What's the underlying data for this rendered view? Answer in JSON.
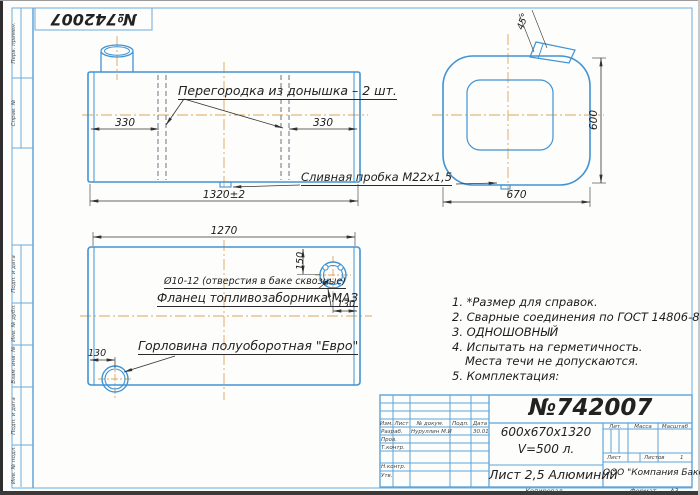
{
  "colors": {
    "line_blue": "#4093d4",
    "frame_blue": "#6cabdc",
    "centerline_orange": "#dca55e",
    "text_black": "#222222"
  },
  "stamp": {
    "number": "№742007"
  },
  "margin": {
    "perv_primen": "Перв. примен.",
    "sprav_no": "Справ. №",
    "podp_data_1": "Подп. и дата",
    "inv_dubl": "Инв. № дубл.",
    "vzam_inv": "Взам. инв. №",
    "podp_data_2": "Подп. и дата",
    "inv_podl": "Инв. № подл."
  },
  "front_view": {
    "partition_label": "Перегородка из донышка – 2 шт.",
    "dim_330_left": "330",
    "dim_330_right": "330",
    "dim_length": "1320±2",
    "drain_label": "Сливная пробка М22х1,5"
  },
  "side_view": {
    "dim_height": "600",
    "dim_width": "670",
    "dim_angle": "45°"
  },
  "top_view": {
    "dim_length": "1270",
    "holes_label": "Ø10-12 (отверстия в баке сквозные)",
    "flange_label": "Фланец топливозаборника МАЗ",
    "neck_label": "Горловина полуоборотная \"Евро\"",
    "dim_flange_top": "150",
    "dim_flange_right": "130",
    "dim_neck_left": "130"
  },
  "notes": {
    "line1": "1. *Размер для справок.",
    "line2": "2. Сварные соединения по ГОСТ 14806-80.",
    "line3": "3. ОДНОШОВНЫЙ",
    "line4": "4. Испытать на герметичность.",
    "line5": "Места течи не допускаются.",
    "line6": "5. Комплектация:"
  },
  "title_block": {
    "doc_number": "№742007",
    "size_line": "600х670х1320",
    "volume_line": "V=500 л.",
    "material": "Лист 2,5 Алюминий",
    "company": "ООО \"Компания Бакор\"",
    "col_izm": "Изм.",
    "col_list": "Лист",
    "col_docum": "№ докум.",
    "col_podp": "Подп.",
    "col_data": "Дата",
    "razrab": "Разраб.",
    "razrab_name": "Нуруллин М.И",
    "razrab_date": "30.01",
    "prov": "Пров.",
    "tkontr": "Т.контр.",
    "nkontr": "Н.контр.",
    "utv": "Утв.",
    "lit": "Лит.",
    "massa": "Масса",
    "masshtab": "Масштаб",
    "list": "Лист",
    "listov": "Листов",
    "listov_value": "1",
    "kopiroval": "Копировал",
    "format_label": "Формат",
    "format_value": "А3"
  }
}
